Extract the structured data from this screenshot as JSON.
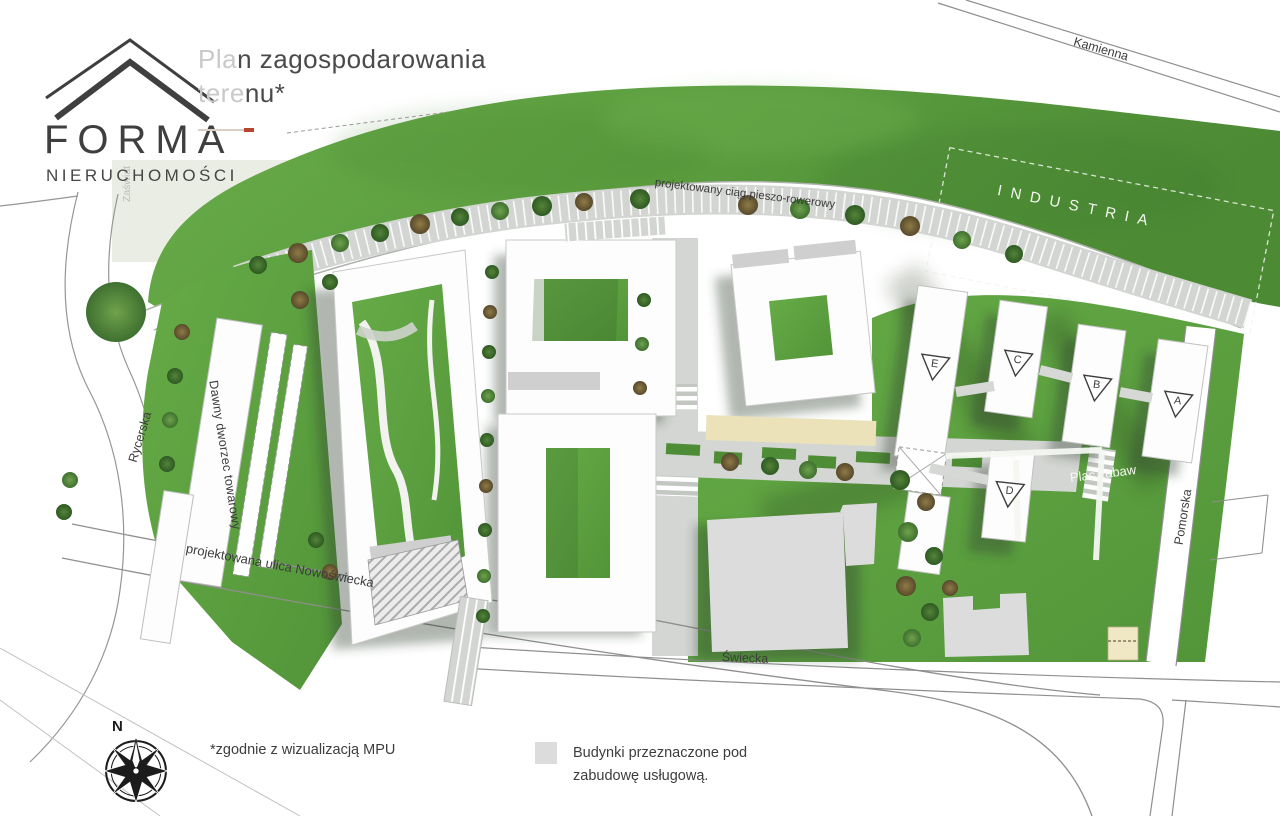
{
  "header": {
    "logo": {
      "name": "FORMA",
      "subtitle": "NIERUCHOMOŚCI"
    },
    "title": {
      "muted1": "Pla",
      "strong1": "n zagospodarowania",
      "muted2": "tere",
      "strong2": "nu",
      "star": "*"
    }
  },
  "map": {
    "streets": {
      "kamienna": "Kamienna",
      "rycerska": "Rycerska",
      "pomorska": "Pomorska",
      "swiecka": "Świecka",
      "nowoswiecka": "projektowana ulica Nowoświecka",
      "zaswiat": "Zaświat"
    },
    "areas": {
      "industria": "INDUSTRIA",
      "plac_zabaw": "Plac zabaw",
      "dworzec": "Dawny dworzec towarowy",
      "path": "projektowany ciąg pieszo-rowerowy"
    },
    "buildings": [
      {
        "letter": "A"
      },
      {
        "letter": "B"
      },
      {
        "letter": "C"
      },
      {
        "letter": "D"
      },
      {
        "letter": "E"
      }
    ]
  },
  "footer": {
    "compass_n": "N",
    "footnote": "*zgodnie z wizualizacją MPU",
    "legend": {
      "line1": "Budynki przeznaczone pod",
      "line2": "zabudowę usługową."
    }
  },
  "colors": {
    "accent": "#b5472e",
    "grass": "#5f9e42",
    "grass_dark": "#4c8a34",
    "plaza_gray": "#d4d6d3",
    "service_building_gray": "#dcdcdc",
    "tan": "#ece2ba",
    "text_dark": "#3f3f3f",
    "text_muted": "#c6c6c6"
  }
}
